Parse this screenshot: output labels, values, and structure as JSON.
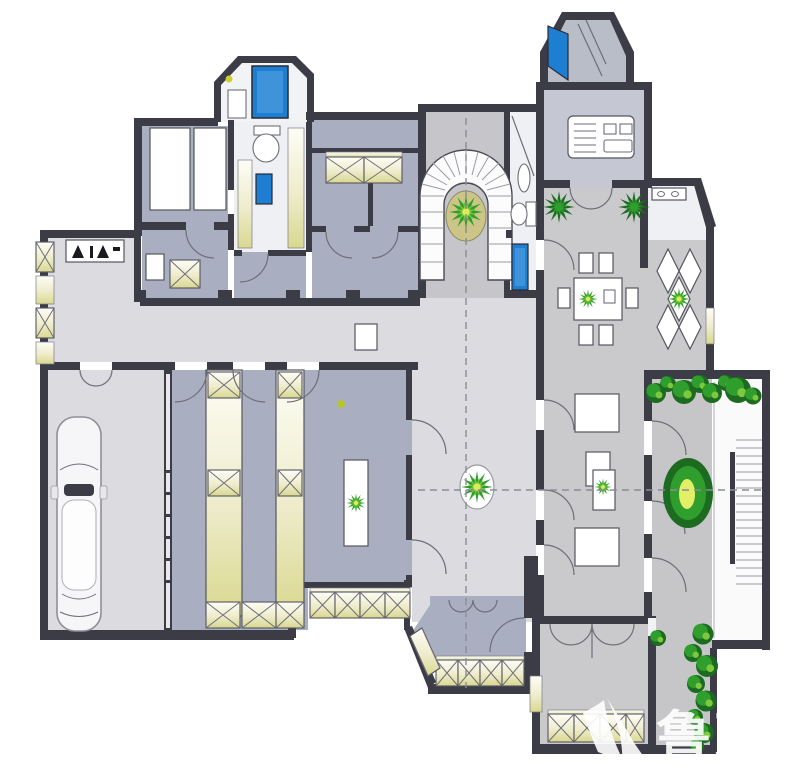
{
  "title": "residential-floor-plan",
  "watermark": {
    "text": "鲁班",
    "logo": "luban-swoosh-logo"
  },
  "colors": {
    "wall": "#3c3c46",
    "line": "#6e6e78",
    "floor_light": "#dcdce0",
    "floor_blue": "#a9afc1",
    "floor_mid": "#cacacd",
    "floor_kitchen": "#c5c8d2",
    "floor_terrace": "#c6c6c9",
    "floor_white": "#eff0f3",
    "window_tint": "#dedd9f",
    "fixture_blue": "#1e7ed2",
    "fixture_blue_dark": "#115a9e",
    "plant_dark": "#1c6b21",
    "plant_mid": "#2f9e2c",
    "plant_light": "#7cc83e",
    "plant_center": "#dcec55",
    "olive": "#cdc487",
    "dash": "#8b8b95",
    "car_line": "#9a9aa2",
    "watermark": "#ffffff"
  },
  "elements": {
    "rooms": [
      "garage",
      "entry-hall",
      "corridor",
      "bedroom-suite",
      "tower-bathroom",
      "spiral-stair-hall",
      "bathroom",
      "kitchen",
      "tower-pantry",
      "dining-room",
      "entrance-foyer",
      "diamond-tile-room",
      "family-room",
      "terrace",
      "bay-window-room",
      "lounge"
    ],
    "fixtures": [
      "bathtub",
      "toilet",
      "shower",
      "wash-basin",
      "kitchen-stove",
      "shoe-cabinet",
      "wardrobe"
    ],
    "furniture": [
      "car",
      "dining-table",
      "dining-chairs",
      "sofa",
      "coffee-table",
      "side-table",
      "round-rug"
    ],
    "stairs": [
      "spiral-staircase",
      "straight-staircase"
    ],
    "plants": [
      "stair-center-plant",
      "hall-rug-plant",
      "cabinet-plant",
      "dining-table-plant",
      "diamond-room-plant",
      "palm-left",
      "palm-right",
      "oval-planter",
      "terrace-shrubs",
      "side-shrubs"
    ]
  }
}
